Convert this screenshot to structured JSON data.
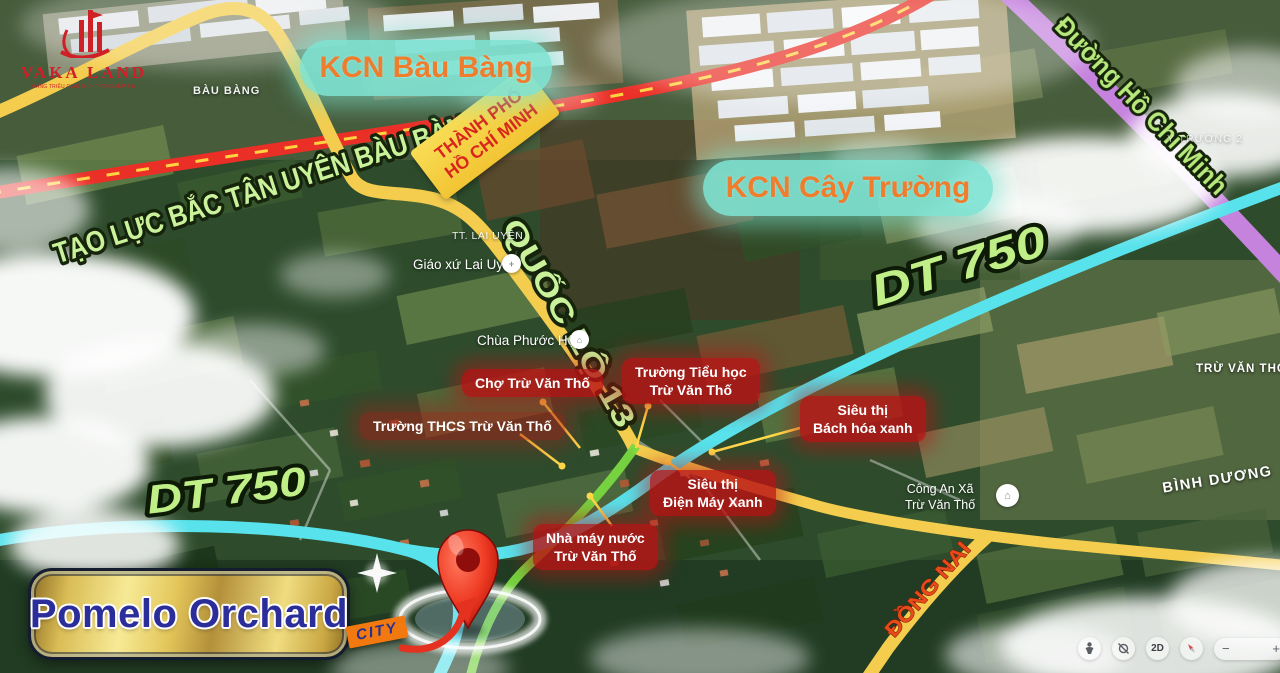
{
  "logo": {
    "name": "VAKA LAND",
    "tagline": "HÀNG TRIỆU GIAO DỊCH TRỌN NIỀM TIN"
  },
  "signs": {
    "hcm_line1": "THÀNH PHỐ",
    "hcm_line2": "HỒ CHÍ MINH",
    "kcn_bau_bang": "KCN Bàu Bàng",
    "kcn_cay_truong": "KCN Cây Trường"
  },
  "roads": {
    "tao_luc": "TẠO LỰC BẮC TÂN UYÊN BÀU BÀNG",
    "quoc_lo_13": "QUỐC LỘ 13",
    "dt750_left": "DT 750",
    "dt750_right": "DT 750",
    "ho_chi_minh": "Đường Hồ Chí Minh",
    "dong_nai": "ĐỒNG NAI"
  },
  "pois": {
    "cho": {
      "line1": "Chợ Trừ Văn Thố"
    },
    "tieu_hoc": {
      "line1": "Trường Tiểu học",
      "line2": "Trừ Văn Thố"
    },
    "thcs": {
      "line1": "Trường THCS Trừ Văn Thố"
    },
    "bhx": {
      "line1": "Siêu thị",
      "line2": "Bách hóa xanh"
    },
    "dmx": {
      "line1": "Siêu thị",
      "line2": "Điện Máy Xanh"
    },
    "nuoc": {
      "line1": "Nhà máy nước",
      "line2": "Trừ Văn Thố"
    }
  },
  "places": {
    "tt_lai_uyen": "TT. LAI UYÊN",
    "giao_xu": "Giáo xứ Lai Uyên",
    "chua": "Chùa Phước Hội",
    "cong_an_line1": "Công An Xã",
    "cong_an_line2": "Trừ Văn Thố",
    "tru_van_tho": "TRỪ VĂN THỐ",
    "binh_duong": "BÌNH DƯƠNG",
    "bau_bang": "BÀU BÀNG",
    "cay_truong_2": "Y TRƯỜNG 2"
  },
  "project": {
    "name": "Pomelo Orchard",
    "tag": "CITY"
  },
  "controls": {
    "mode": "2D",
    "zoom_out": "−",
    "zoom_in": "+"
  },
  "colors": {
    "road_yellow": "#f4cd4e",
    "road_red": "#ea2f27",
    "road_cyan": "#57e2ec",
    "road_purple": "#c583de",
    "road_green": "#79d840",
    "label_green": "#c9f29b",
    "badge_red": "#ba1214",
    "banner_teal": "#7fe3d2",
    "banner_text": "#ee7d2e",
    "navy": "#2b2d9b",
    "city_orange": "#f2790f",
    "pin_red": "#e02718"
  }
}
